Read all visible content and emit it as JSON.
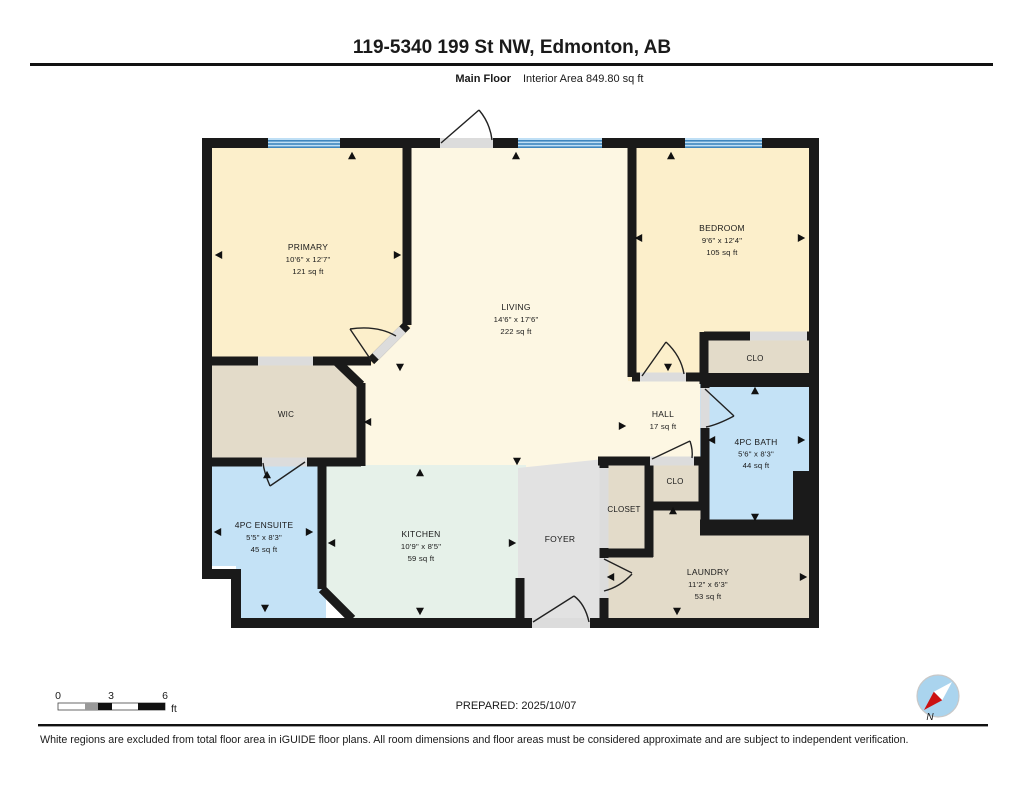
{
  "header": {
    "title": "119-5340 199 St NW, Edmonton, AB",
    "floor_label": "Main Floor",
    "area_label": "Interior Area 849.80 sq ft"
  },
  "plan": {
    "rooms": [
      {
        "name": "PRIMARY",
        "dims": "10'6\" x 12'7\"",
        "area": "121 sq ft"
      },
      {
        "name": "LIVING",
        "dims": "14'6\" x 17'6\"",
        "area": "222 sq ft"
      },
      {
        "name": "BEDROOM",
        "dims": "9'6\" x 12'4\"",
        "area": "105 sq ft"
      },
      {
        "name": "WIC"
      },
      {
        "name": "CLO"
      },
      {
        "name": "HALL",
        "area": "17 sq ft"
      },
      {
        "name": "4PC BATH",
        "dims": "5'6\" x 8'3\"",
        "area": "44 sq ft"
      },
      {
        "name": "CLO"
      },
      {
        "name": "CLOSET"
      },
      {
        "name": "4PC ENSUITE",
        "dims": "5'5\" x 8'3\"",
        "area": "45 sq ft"
      },
      {
        "name": "KITCHEN",
        "dims": "10'9\" x 8'5\"",
        "area": "59 sq ft"
      },
      {
        "name": "FOYER"
      },
      {
        "name": "LAUNDRY",
        "dims": "11'2\" x 6'3\"",
        "area": "53 sq ft"
      }
    ]
  },
  "scale_bar": {
    "tick_0": "0",
    "tick_3": "3",
    "tick_6": "6",
    "unit": "ft"
  },
  "footer": {
    "prepared": "PREPARED: 2025/10/07",
    "compass_north": "N",
    "disclaimer": "White regions are excluded from total floor area in iGUIDE floor plans. All room dimensions and floor areas must be considered approximate and are subject to independent verification."
  },
  "colors": {
    "room_cream": "#FCEFCB",
    "room_cream_light": "#FDF7E3",
    "room_tan": "#E3DBC9",
    "room_blue": "#C4E2F6",
    "room_green": "#E6F1E9",
    "room_gray": "#E2E2E2",
    "wall": "#1A1A1A",
    "door_gap": "#DCDCDC",
    "window_blue": "#BFDFF5",
    "window_stripe": "#3F86BE"
  }
}
